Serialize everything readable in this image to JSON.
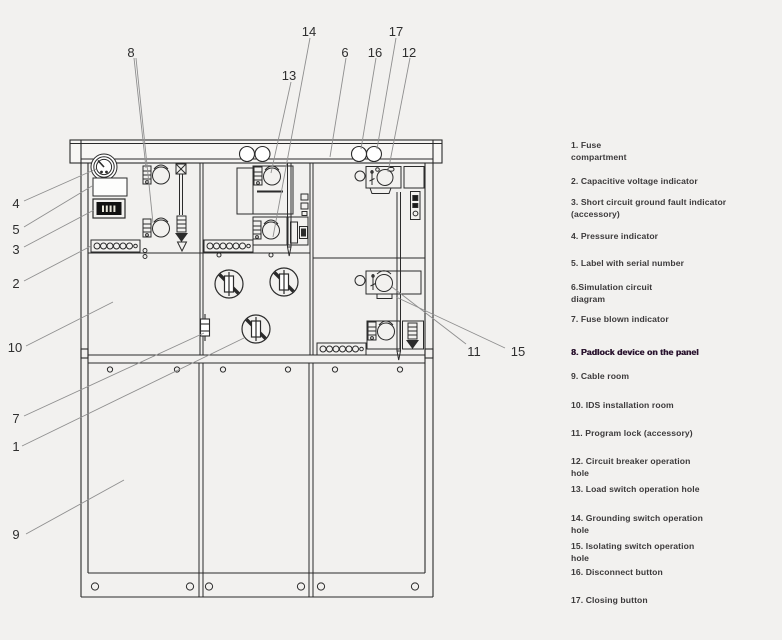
{
  "colors": {
    "background": "#f2f1ef",
    "drawing_line": "#2b2b2b",
    "leader_line": "#8f8f8f",
    "legend_text": "#3c3a3b",
    "legend_highlight": "#2b1530"
  },
  "diagram": {
    "description": "Front view line drawing of ring main unit switchgear cabinet with numbered callouts",
    "callouts": {
      "c1": "1",
      "c2": "2",
      "c3": "3",
      "c4": "4",
      "c5": "5",
      "c6": "6",
      "c7": "7",
      "c8": "8",
      "c9": "9",
      "c10": "10",
      "c11": "11",
      "c12": "12",
      "c13": "13",
      "c14": "14",
      "c15": "15",
      "c16": "16",
      "c17": "17"
    }
  },
  "legend": {
    "items": [
      {
        "num": "1",
        "lines": [
          "1. Fuse",
          "compartment"
        ]
      },
      {
        "num": "2",
        "lines": [
          "2. Capacitive voltage indicator"
        ]
      },
      {
        "num": "3",
        "lines": [
          "3. Short circuit ground fault indicator",
          "(accessory)"
        ]
      },
      {
        "num": "4",
        "lines": [
          "4. Pressure indicator"
        ]
      },
      {
        "num": "5",
        "lines": [
          "5. Label with serial number"
        ]
      },
      {
        "num": "6",
        "lines": [
          "6.Simulation circuit",
          "diagram"
        ]
      },
      {
        "num": "7",
        "lines": [
          "7. Fuse blown indicator"
        ]
      },
      {
        "num": "8",
        "lines": [
          "8. Padlock device on the panel"
        ],
        "bold": true
      },
      {
        "num": "9",
        "lines": [
          "9. Cable room"
        ]
      },
      {
        "num": "10",
        "lines": [
          "10. IDS installation room"
        ]
      },
      {
        "num": "11",
        "lines": [
          "11. Program lock (accessory)"
        ]
      },
      {
        "num": "12",
        "lines": [
          "12. Circuit breaker operation",
          "hole"
        ]
      },
      {
        "num": "13",
        "lines": [
          "13. Load switch operation hole"
        ]
      },
      {
        "num": "14",
        "lines": [
          "14. Grounding switch operation",
          "hole"
        ]
      },
      {
        "num": "15",
        "lines": [
          "15. Isolating switch operation",
          "hole"
        ]
      },
      {
        "num": "16",
        "lines": [
          "16. Disconnect button"
        ]
      },
      {
        "num": "17",
        "lines": [
          "17. Closing button"
        ]
      }
    ]
  }
}
